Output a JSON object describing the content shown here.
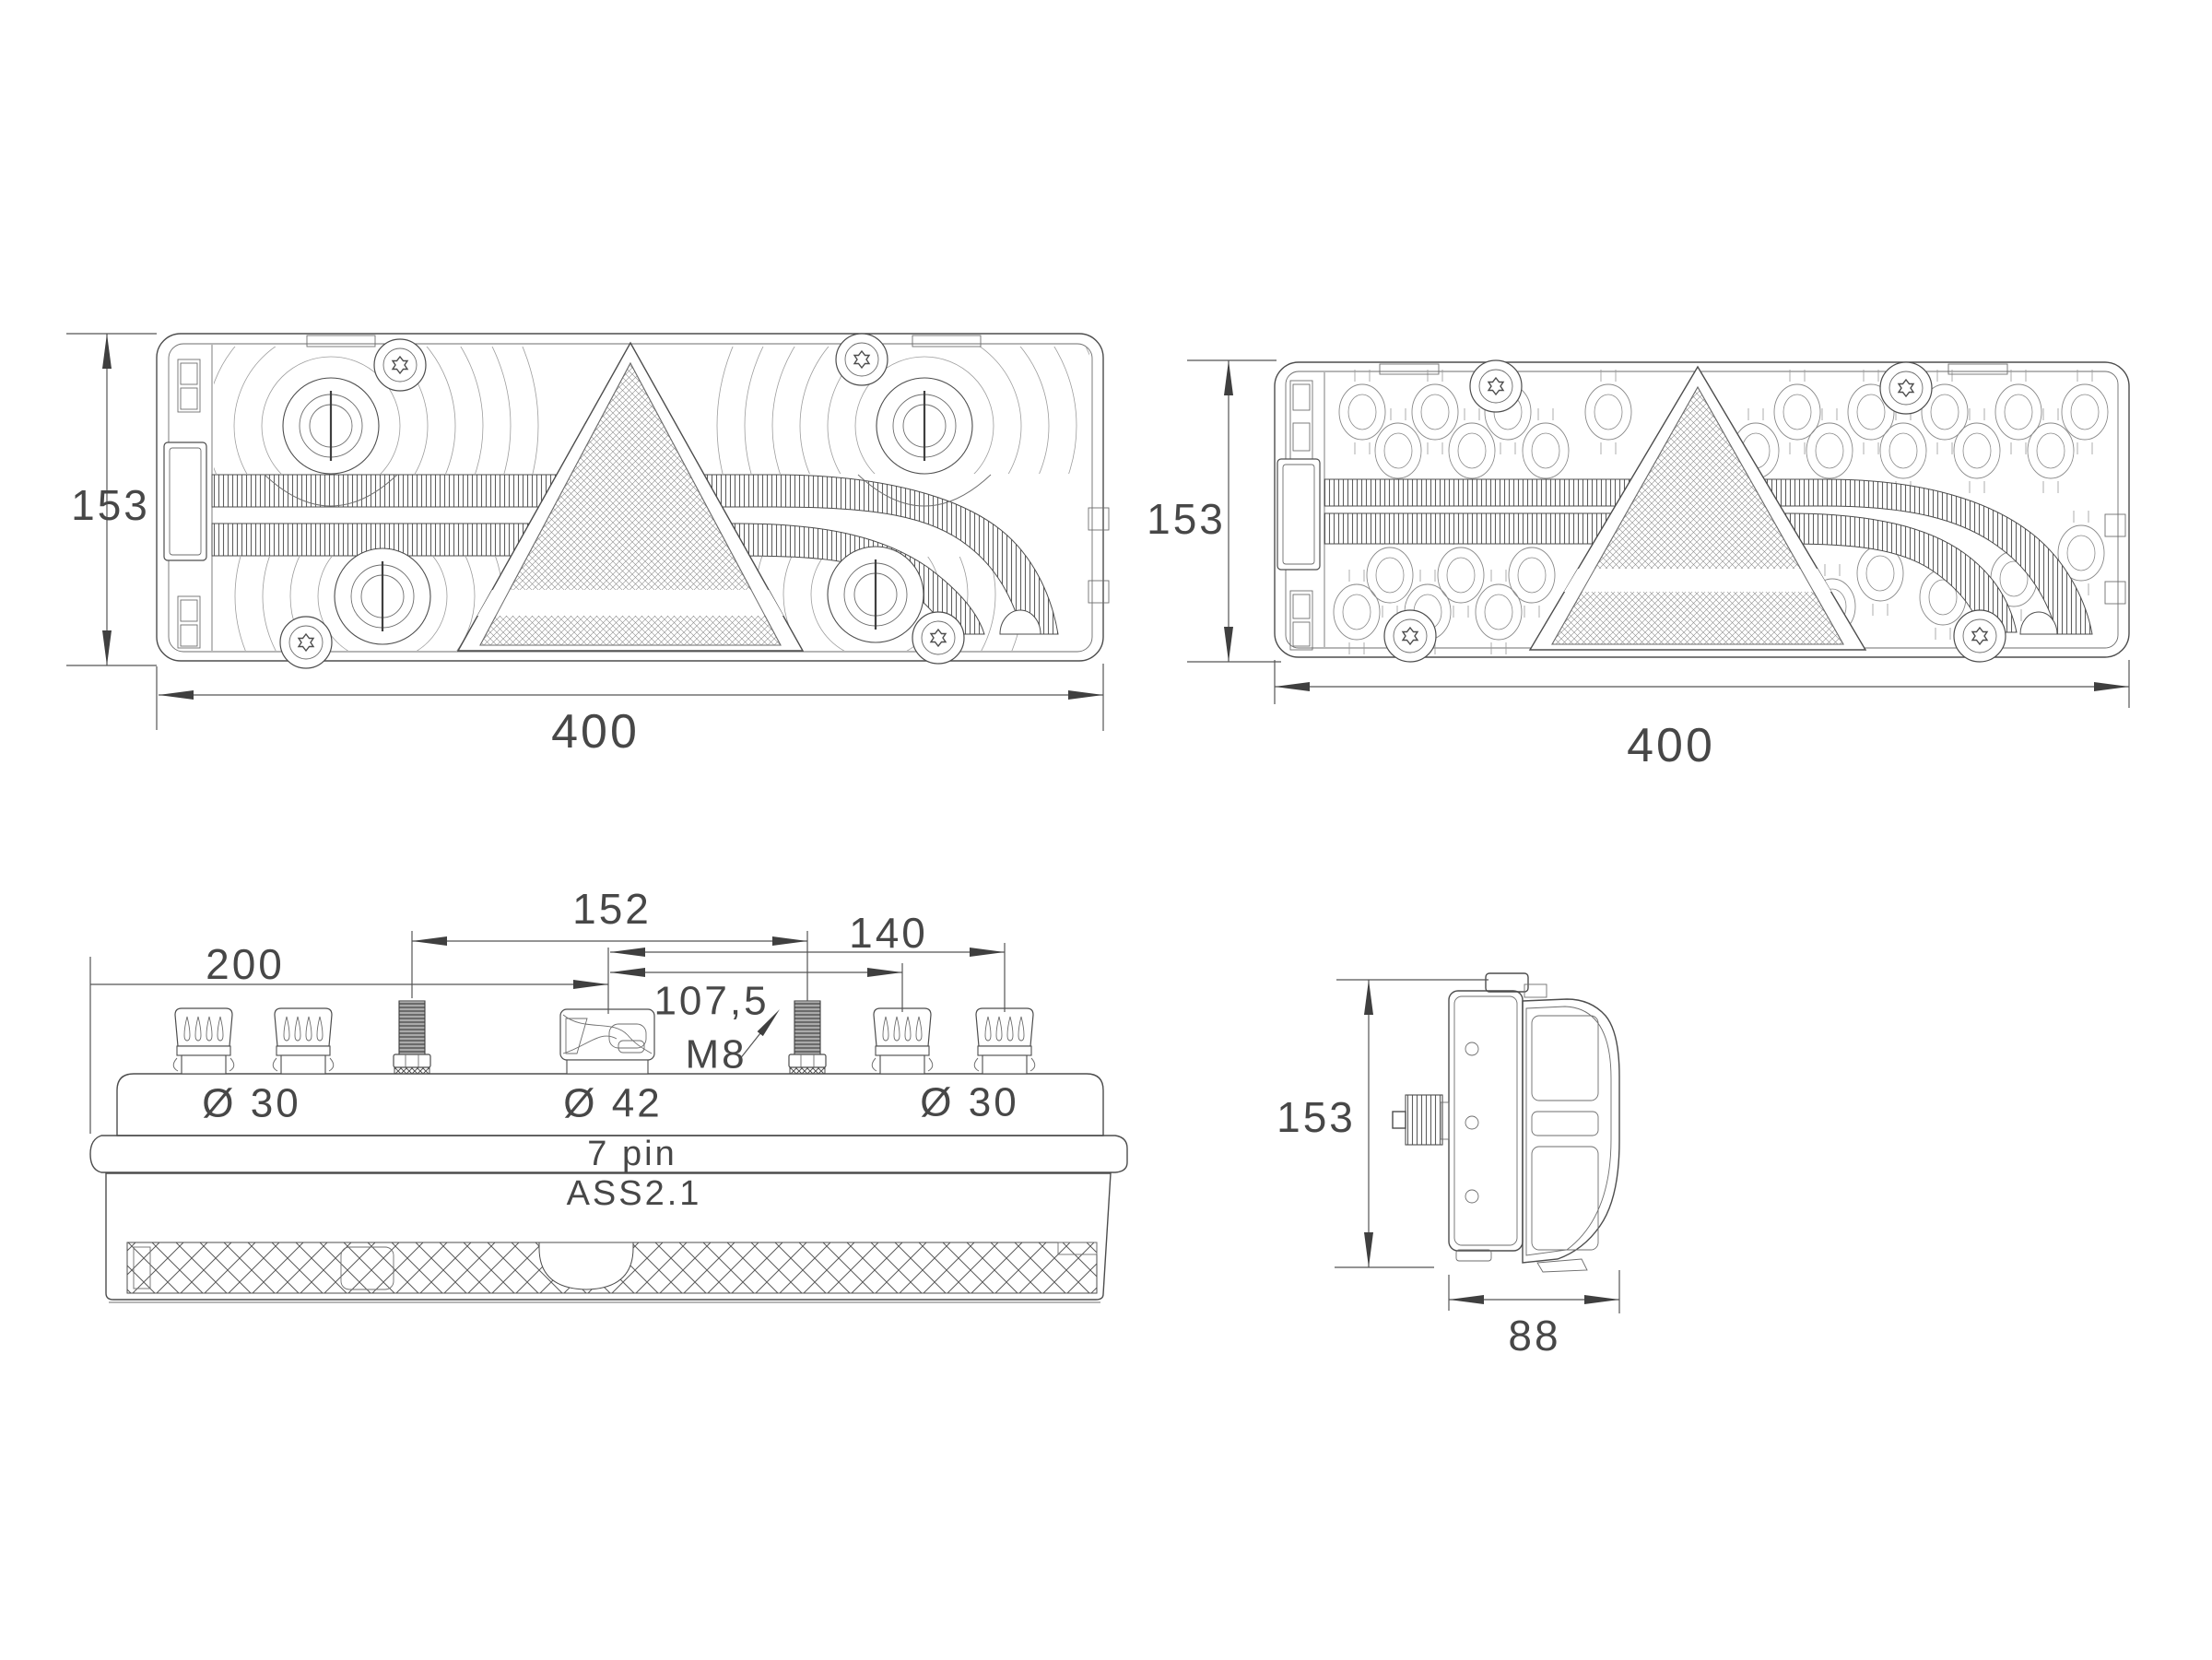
{
  "document": {
    "type": "technical-drawing",
    "subject": "trailer multifunction rear lamp, four orthographic views",
    "background": "#ffffff",
    "line_color": "#4d4d4d",
    "text_color": "#474747"
  },
  "views": {
    "front": {
      "height": "153",
      "width": "400"
    },
    "rear": {
      "height": "153",
      "width": "400"
    },
    "top": {
      "dim_200": "200",
      "dim_152": "152",
      "dim_140": "140",
      "dim_107_5": "107,5",
      "thread": "M8",
      "dia_left": "Ø 30",
      "dia_center": "Ø 42",
      "dia_right": "Ø 30",
      "connector": "7 pin",
      "assembly": "ASS2.1"
    },
    "side": {
      "height": "153",
      "depth": "88"
    }
  }
}
